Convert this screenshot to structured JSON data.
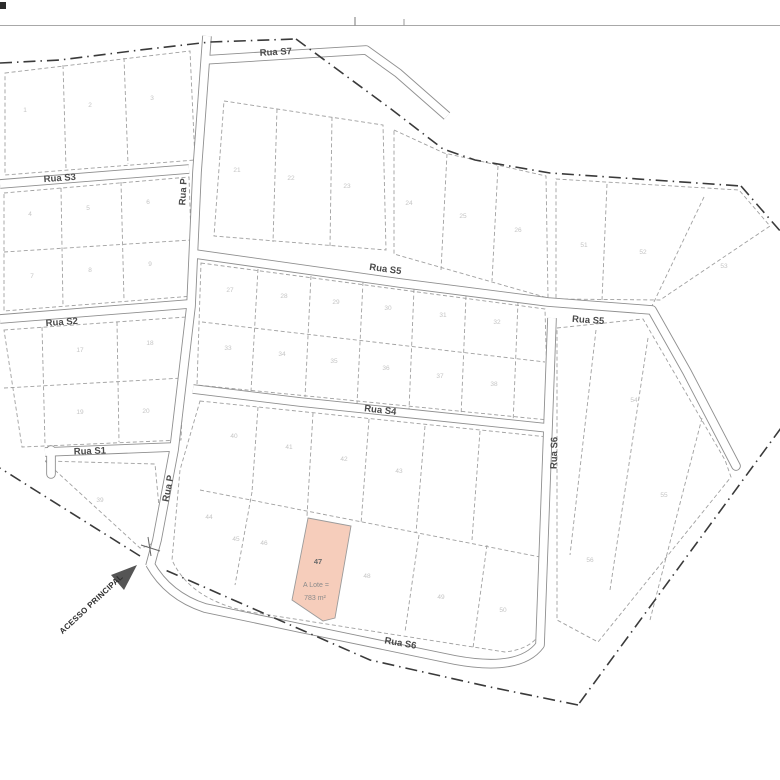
{
  "colors": {
    "highlight": "#f6cdbb",
    "boundary": "#3a3a3a",
    "road": "#8f8f8f",
    "parcel": "#a0a0a0",
    "street_label": "#4a4a4a",
    "lot_number": "#c4c4c4",
    "arrow": "#555555"
  },
  "map": {
    "streets": {
      "s7": "Rua S7",
      "s5_main": "Rua S5",
      "s5_ext": "Rua S5",
      "s4": "Rua S4",
      "s3": "Rua S3",
      "s2": "Rua S2",
      "s1": "Rua S1",
      "p_upper": "Rua P",
      "p_lower": "Rua P",
      "s6_vertical": "Rua S6",
      "s6_bottom": "Rua S6"
    },
    "access_label": "ACESSO PRINCIPAL",
    "highlighted_lot": {
      "number": "47",
      "area_prefix": "A Lote =",
      "area": "783 m²"
    },
    "lot_numbers": [
      {
        "n": "1",
        "x": 25,
        "y": 112
      },
      {
        "n": "2",
        "x": 90,
        "y": 107
      },
      {
        "n": "3",
        "x": 152,
        "y": 100
      },
      {
        "n": "4",
        "x": 30,
        "y": 216
      },
      {
        "n": "5",
        "x": 88,
        "y": 210
      },
      {
        "n": "6",
        "x": 148,
        "y": 204
      },
      {
        "n": "7",
        "x": 32,
        "y": 278
      },
      {
        "n": "8",
        "x": 90,
        "y": 272
      },
      {
        "n": "9",
        "x": 150,
        "y": 266
      },
      {
        "n": "17",
        "x": 80,
        "y": 352
      },
      {
        "n": "18",
        "x": 150,
        "y": 345
      },
      {
        "n": "19",
        "x": 80,
        "y": 414
      },
      {
        "n": "20",
        "x": 146,
        "y": 413
      },
      {
        "n": "21",
        "x": 237,
        "y": 172
      },
      {
        "n": "22",
        "x": 291,
        "y": 180
      },
      {
        "n": "23",
        "x": 347,
        "y": 188
      },
      {
        "n": "24",
        "x": 409,
        "y": 205
      },
      {
        "n": "25",
        "x": 463,
        "y": 218
      },
      {
        "n": "26",
        "x": 518,
        "y": 232
      },
      {
        "n": "51",
        "x": 584,
        "y": 247
      },
      {
        "n": "52",
        "x": 643,
        "y": 254
      },
      {
        "n": "53",
        "x": 724,
        "y": 268
      },
      {
        "n": "27",
        "x": 230,
        "y": 292
      },
      {
        "n": "28",
        "x": 284,
        "y": 298
      },
      {
        "n": "29",
        "x": 336,
        "y": 304
      },
      {
        "n": "30",
        "x": 388,
        "y": 310
      },
      {
        "n": "31",
        "x": 443,
        "y": 317
      },
      {
        "n": "32",
        "x": 497,
        "y": 324
      },
      {
        "n": "33",
        "x": 228,
        "y": 350
      },
      {
        "n": "34",
        "x": 282,
        "y": 356
      },
      {
        "n": "35",
        "x": 334,
        "y": 363
      },
      {
        "n": "36",
        "x": 386,
        "y": 370
      },
      {
        "n": "37",
        "x": 440,
        "y": 378
      },
      {
        "n": "38",
        "x": 494,
        "y": 386
      },
      {
        "n": "39",
        "x": 100,
        "y": 502
      },
      {
        "n": "40",
        "x": 234,
        "y": 438
      },
      {
        "n": "41",
        "x": 289,
        "y": 449
      },
      {
        "n": "42",
        "x": 344,
        "y": 461
      },
      {
        "n": "43",
        "x": 399,
        "y": 473
      },
      {
        "n": "44",
        "x": 209,
        "y": 519
      },
      {
        "n": "45",
        "x": 236,
        "y": 541
      },
      {
        "n": "46",
        "x": 264,
        "y": 545
      },
      {
        "n": "48",
        "x": 367,
        "y": 578
      },
      {
        "n": "49",
        "x": 441,
        "y": 599
      },
      {
        "n": "50",
        "x": 503,
        "y": 612
      },
      {
        "n": "54",
        "x": 634,
        "y": 402
      },
      {
        "n": "55",
        "x": 664,
        "y": 497
      },
      {
        "n": "56",
        "x": 590,
        "y": 562
      }
    ]
  }
}
